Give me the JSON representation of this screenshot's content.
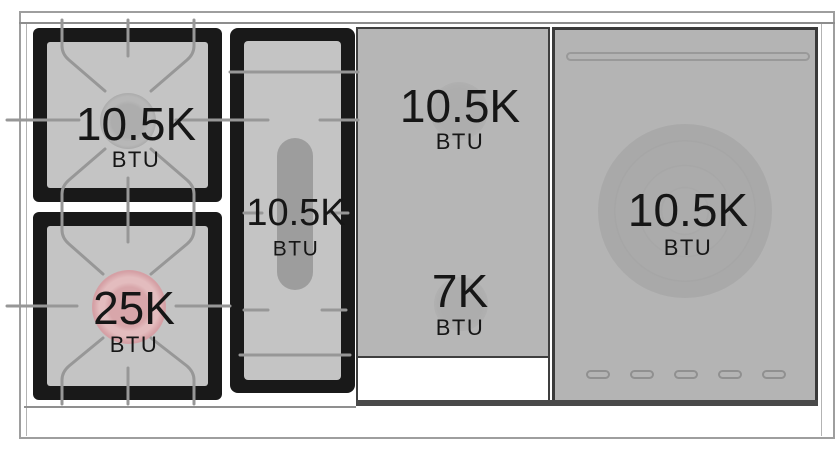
{
  "diagram_title": "range-cooktop-btu-diagram",
  "zones": {
    "left_rear": {
      "rating": "10.5K",
      "unit": "BTU"
    },
    "left_front": {
      "rating": "25K",
      "unit": "BTU"
    },
    "center_oval": {
      "rating": "10.5K",
      "unit": "BTU"
    },
    "griddle_rear": {
      "rating": "10.5K",
      "unit": "BTU"
    },
    "griddle_front": {
      "rating": "7K",
      "unit": "BTU"
    },
    "french_top": {
      "rating": "10.5K",
      "unit": "BTU"
    }
  },
  "colors": {
    "power_burner_highlight": "#d7a2a7",
    "standard_burner_cap": "#a9a9a9",
    "surface_gray": "#b6b6b6",
    "grate_black": "#191919",
    "grate_line_gray": "#979797",
    "frame_border": "#9e9e9e"
  }
}
